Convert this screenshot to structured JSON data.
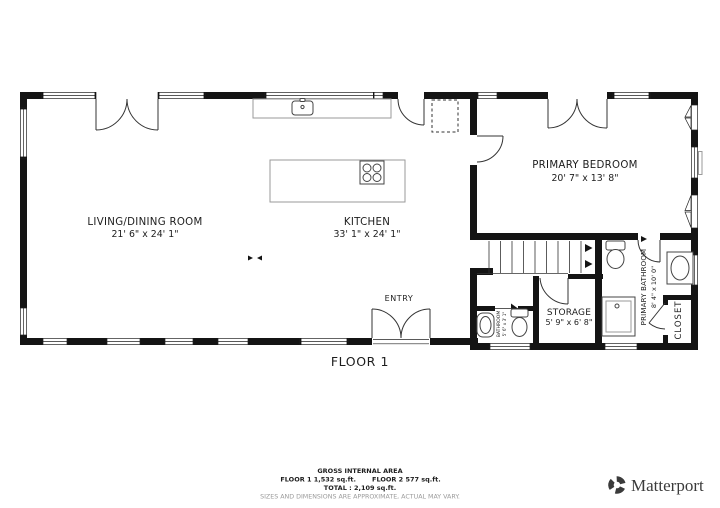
{
  "plan": {
    "floor_label": "FLOOR 1",
    "rooms": {
      "living": {
        "name": "LIVING/DINING ROOM",
        "dims": "21' 6\" x 24' 1\""
      },
      "kitchen": {
        "name": "KITCHEN",
        "dims": "33' 1\" x 24' 1\""
      },
      "primary_bedroom": {
        "name": "PRIMARY BEDROOM",
        "dims": "20' 7\" x 13' 8\""
      },
      "entry": {
        "name": "ENTRY"
      },
      "storage": {
        "name": "STORAGE",
        "dims": "5' 9\" x 6' 8\""
      },
      "primary_bathroom": {
        "name": "PRIMARY BATHROOM",
        "dims": "8' 4\" x 10' 0\""
      },
      "bathroom": {
        "name": "BATHROOM",
        "dims": "5' 6\" x 3' 1\""
      },
      "closet": {
        "name": "CLOSET"
      }
    }
  },
  "footer": {
    "gross_label": "GROSS INTERNAL AREA",
    "floor1_area": "FLOOR 1 1,532 sq.ft.",
    "floor2_area": "FLOOR 2 577 sq.ft.",
    "total_line": "TOTAL :  2,109 sq.ft.",
    "disclaimer": "SIZES AND DIMENSIONS ARE APPROXIMATE, ACTUAL MAY VARY.",
    "brand": "Matterport"
  },
  "colors": {
    "wall": "#141414",
    "brand_text": "#3b3b3b",
    "disclaimer_text": "#9a9a9a"
  }
}
